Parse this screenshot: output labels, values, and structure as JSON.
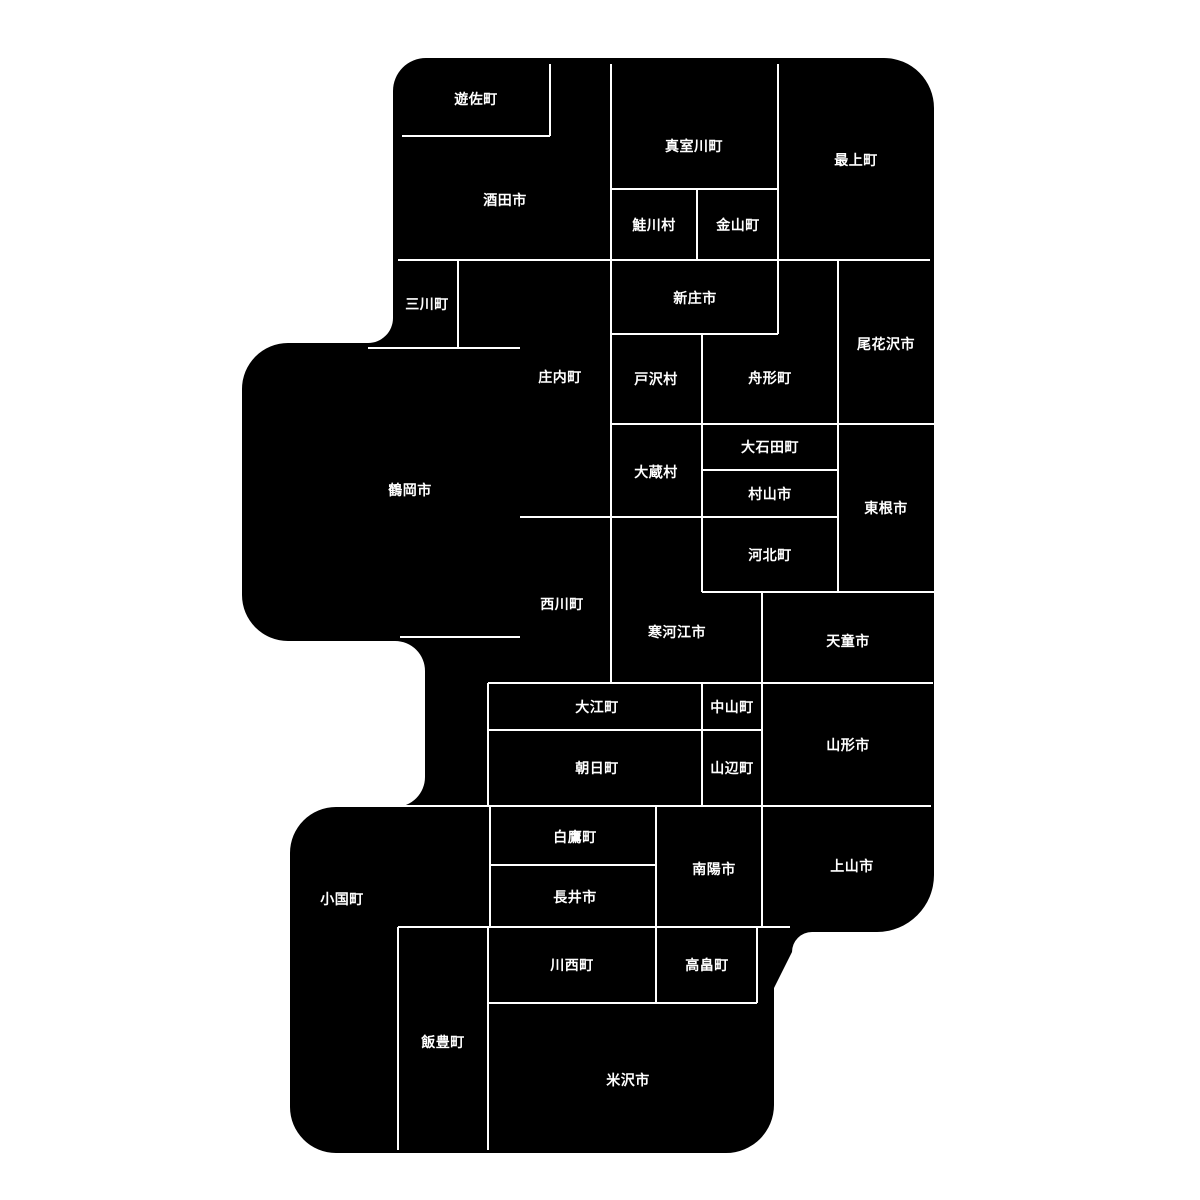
{
  "map": {
    "colors": {
      "background": "#ffffff",
      "region_fill": "#000000",
      "border": "#ffffff",
      "label": "#ffffff"
    },
    "regions": [
      {
        "name": "yuza",
        "label": "遊佐町",
        "x": 476,
        "y": 99
      },
      {
        "name": "sakata",
        "label": "酒田市",
        "x": 505,
        "y": 200
      },
      {
        "name": "mamurogawa",
        "label": "真室川町",
        "x": 694,
        "y": 146
      },
      {
        "name": "sakegawa",
        "label": "鮭川村",
        "x": 654,
        "y": 225
      },
      {
        "name": "kaneyama",
        "label": "金山町",
        "x": 738,
        "y": 225
      },
      {
        "name": "mogami",
        "label": "最上町",
        "x": 856,
        "y": 160
      },
      {
        "name": "mikawa",
        "label": "三川町",
        "x": 427,
        "y": 304
      },
      {
        "name": "shonai",
        "label": "庄内町",
        "x": 560,
        "y": 377
      },
      {
        "name": "shinjo",
        "label": "新庄市",
        "x": 695,
        "y": 298
      },
      {
        "name": "tozawa",
        "label": "戸沢村",
        "x": 656,
        "y": 379
      },
      {
        "name": "funagata",
        "label": "舟形町",
        "x": 770,
        "y": 378
      },
      {
        "name": "obanazawa",
        "label": "尾花沢市",
        "x": 886,
        "y": 344
      },
      {
        "name": "tsuruoka",
        "label": "鶴岡市",
        "x": 410,
        "y": 490
      },
      {
        "name": "okura",
        "label": "大蔵村",
        "x": 656,
        "y": 472
      },
      {
        "name": "oishida",
        "label": "大石田町",
        "x": 770,
        "y": 447
      },
      {
        "name": "murayama",
        "label": "村山市",
        "x": 770,
        "y": 494
      },
      {
        "name": "higashine",
        "label": "東根市",
        "x": 886,
        "y": 508
      },
      {
        "name": "kahoku",
        "label": "河北町",
        "x": 770,
        "y": 555
      },
      {
        "name": "nishikawa",
        "label": "西川町",
        "x": 562,
        "y": 604
      },
      {
        "name": "sagae",
        "label": "寒河江市",
        "x": 677,
        "y": 632
      },
      {
        "name": "tendo",
        "label": "天童市",
        "x": 848,
        "y": 641
      },
      {
        "name": "oe",
        "label": "大江町",
        "x": 597,
        "y": 707
      },
      {
        "name": "nakayama",
        "label": "中山町",
        "x": 732,
        "y": 707
      },
      {
        "name": "asahi",
        "label": "朝日町",
        "x": 597,
        "y": 768
      },
      {
        "name": "yamanobe",
        "label": "山辺町",
        "x": 732,
        "y": 768
      },
      {
        "name": "yamagata",
        "label": "山形市",
        "x": 848,
        "y": 745
      },
      {
        "name": "shirataka",
        "label": "白鷹町",
        "x": 575,
        "y": 837
      },
      {
        "name": "nagai",
        "label": "長井市",
        "x": 575,
        "y": 897
      },
      {
        "name": "nanyo",
        "label": "南陽市",
        "x": 714,
        "y": 869
      },
      {
        "name": "kaminoyama",
        "label": "上山市",
        "x": 852,
        "y": 866
      },
      {
        "name": "oguni",
        "label": "小国町",
        "x": 342,
        "y": 899
      },
      {
        "name": "iide",
        "label": "飯豊町",
        "x": 443,
        "y": 1042
      },
      {
        "name": "kawanishi",
        "label": "川西町",
        "x": 572,
        "y": 965
      },
      {
        "name": "takahata",
        "label": "高畠町",
        "x": 707,
        "y": 965
      },
      {
        "name": "yonezawa",
        "label": "米沢市",
        "x": 628,
        "y": 1080
      }
    ]
  }
}
